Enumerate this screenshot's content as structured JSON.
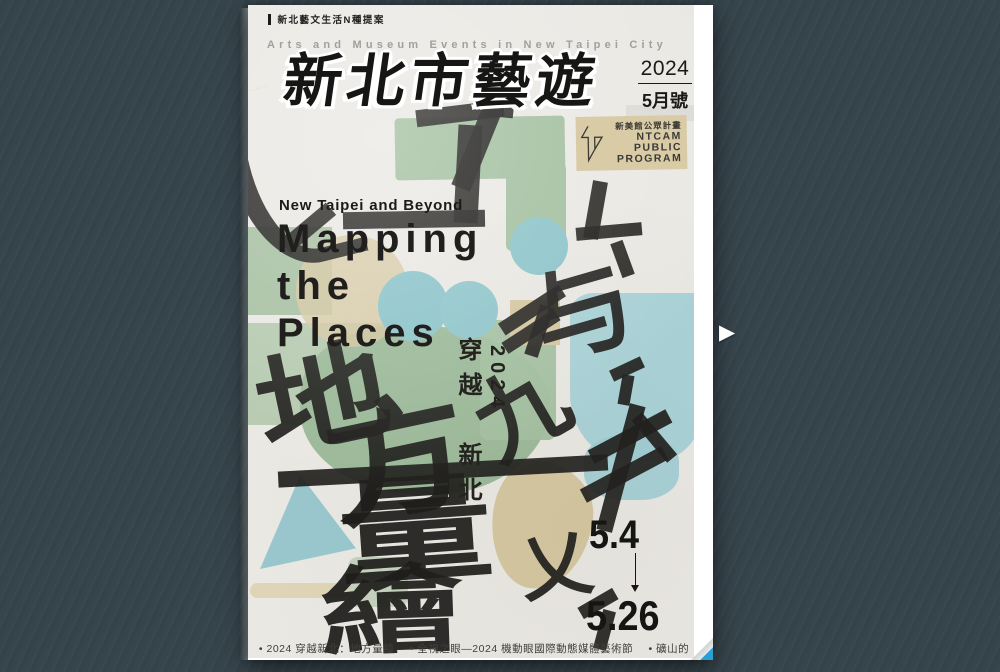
{
  "viewer": {
    "next_arrow_icon": "▶",
    "background_color": "#36444b",
    "page_curl_color": "#2b9fd2"
  },
  "cover": {
    "top_label": "新北藝文生活N種提案",
    "tagline": "Arts and Museum Events in New Taipei City",
    "title": "新北市藝遊",
    "issue": {
      "year": "2024",
      "month": "5月號"
    },
    "program": {
      "name_zh": "新美館公眾計畫",
      "lines": [
        "NTCAM",
        "PUBLIC",
        "PROGRAM"
      ],
      "logo_icon": "zigzag-n"
    },
    "theme": {
      "subtitle": "New Taipei and Beyond",
      "heading_lines": [
        "Mapping",
        "the",
        "Places"
      ]
    },
    "vertical_text": {
      "year": "2024",
      "phrase": "穿越　新北"
    },
    "art_characters": [
      "地",
      "方",
      "量",
      "繪",
      "与",
      "九",
      "乂"
    ],
    "dates": {
      "start": "5.4",
      "end": "5.26",
      "icon": "down-arrow"
    },
    "footer_items": [
      "• 2024 穿越新北：地方量繪",
      "• 全視之眼—2024 機動眼國際動態媒體藝術節",
      "• 礦山的南丁格爾"
    ],
    "colors": {
      "paper": "#eae8e3",
      "ink": "#1d1c1a",
      "green": "#a4bfa0",
      "blue_circle": "#8bc4ca",
      "pale_blue": "#a5d1d6",
      "tan": "#d6c8a1"
    }
  }
}
